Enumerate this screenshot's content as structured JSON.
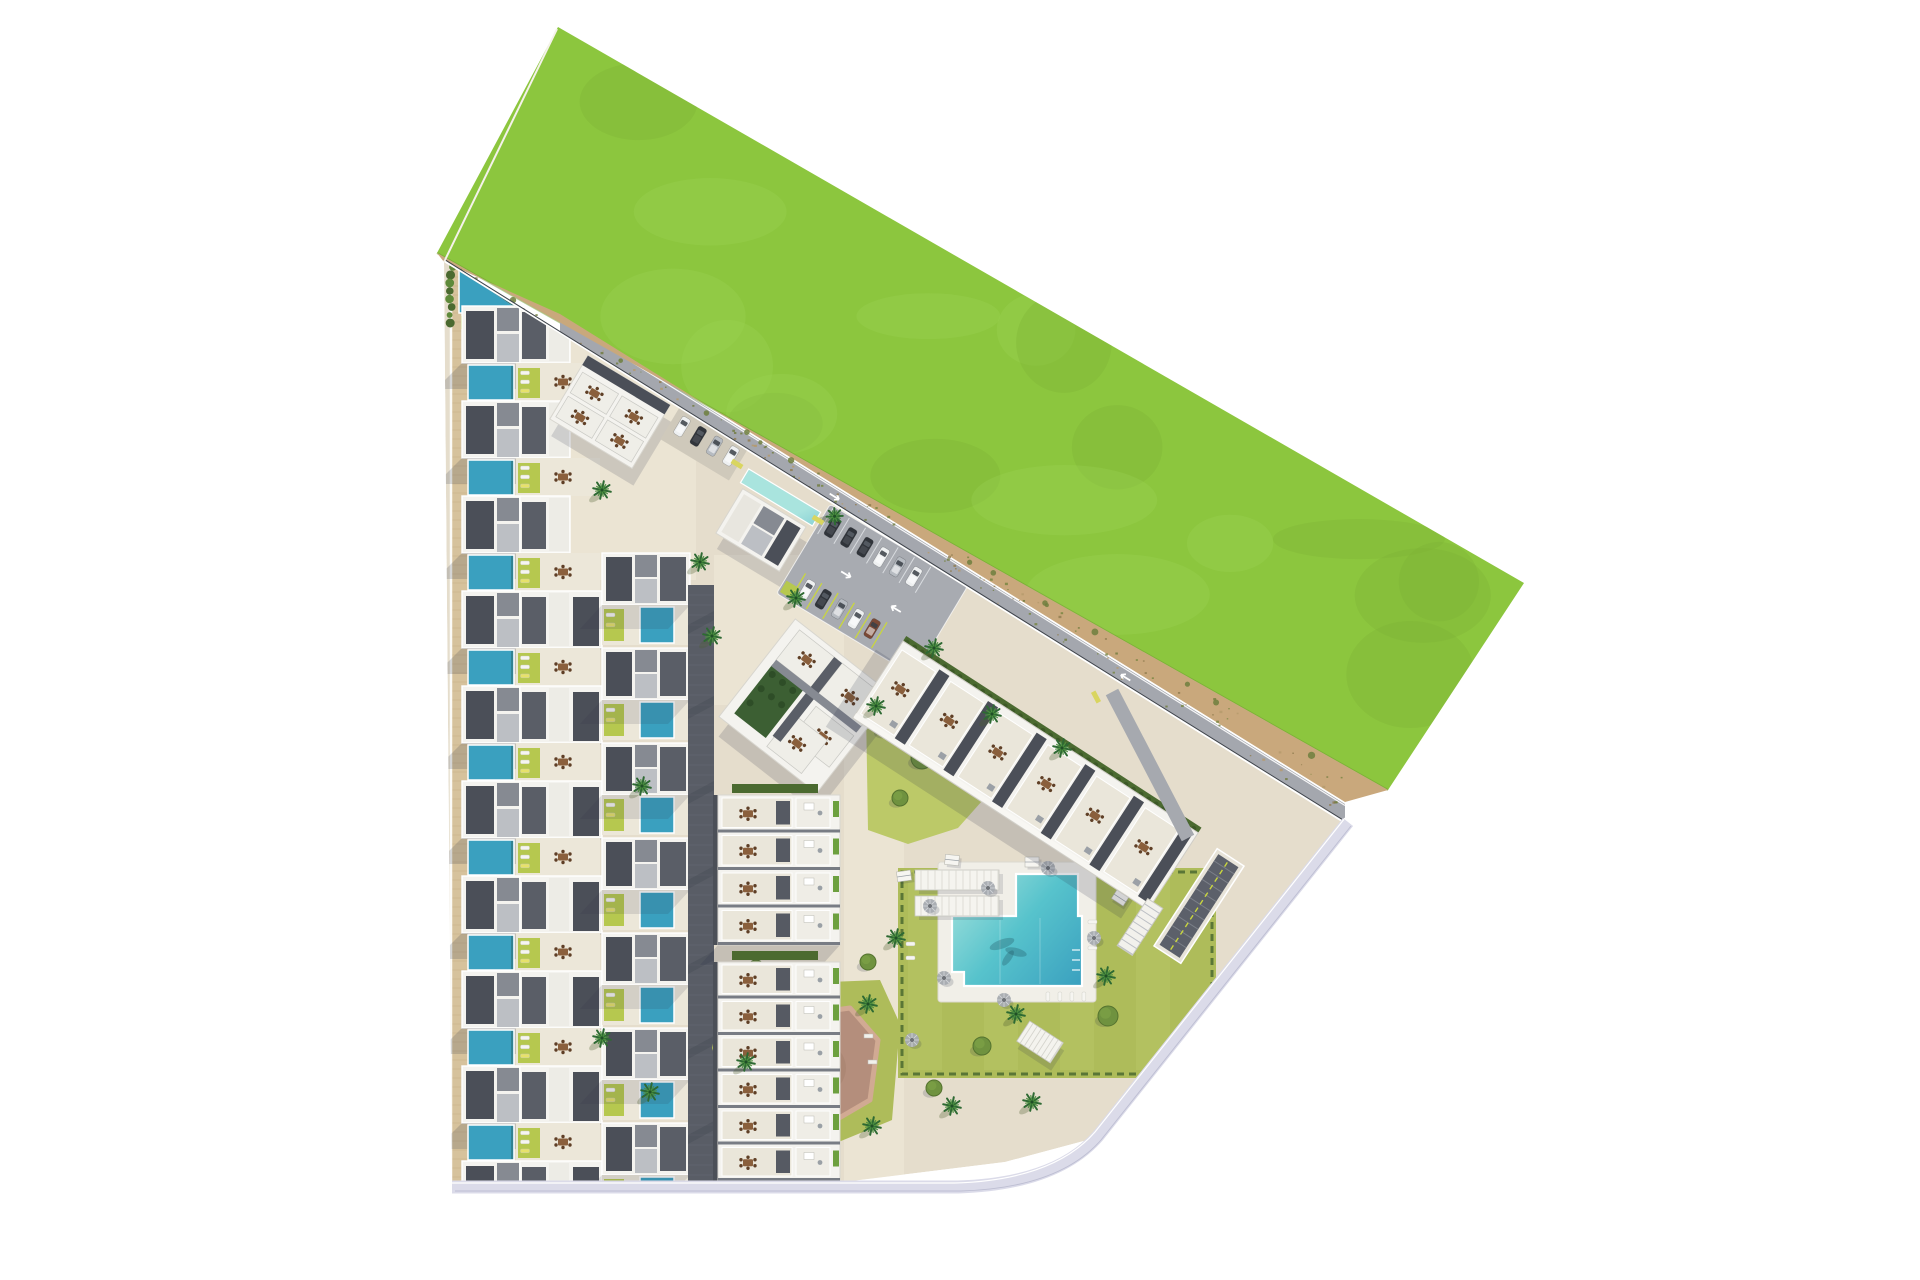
{
  "scene": {
    "type": "residential-masterplan-aerial-rendering",
    "background": "#ffffff",
    "description": "Top-down architectural site plan: rows of townhouses with private pools on the west, apartment blocks and parking in the centre, communal garden with swimming pool and playground on the south-east, large green field across the north-east, sandy track along the diagonal boundary."
  },
  "palette": {
    "bg": "#ffffff",
    "field_green": "#8cc63e",
    "field_green_light": "#9cd355",
    "field_green_dark": "#7cb134",
    "dirt": "#c9a87c",
    "dirt_dark": "#8f7a4e",
    "dirt_olive": "#75853e",
    "dirt_light": "#b59a6b",
    "road": "#a4a7ae",
    "road_edge": "#ffffff",
    "se_road": "#dbdbe9",
    "se_road_edge": "#b9bacf",
    "pavement": "#e5ddcc",
    "pavement_light": "#ece5d5",
    "tan_path": "#d6c29c",
    "tan_tick": "#c4ae84",
    "lane": "#595d66",
    "lane_line": "#6a6e77",
    "building_white": "#f4f3ef",
    "floor_beige": "#eae6da",
    "roof_dark": "#4b4f58",
    "roof_slate": "#5a5e67",
    "roof_mid": "#868a92",
    "roof_light": "#bcbfc4",
    "pool_light": "#a9e4de",
    "pool_mid": "#57c3cc",
    "pool_deep": "#3aa0bf",
    "chartreuse": "#b6c84f",
    "olive_lawn": "#aebc5a",
    "olive_light": "#bcc968",
    "hedge": "#4b6a30",
    "tree_green": "#6f923f",
    "palm_green": "#2e6a33",
    "palm_light": "#4c8f3f",
    "shadow": "#2b3148",
    "wood": "#8a5f3c",
    "wood_dark": "#5f3f26",
    "yellow": "#d9d560",
    "stall_yellow": "#c9d63e",
    "play_pad": "#b48e7c",
    "play_ring": "#d1aa93",
    "play_dark": "#9f7a68",
    "parasol": "#a7abb0",
    "car_dark": "#30343a",
    "car_white": "#eef0f1",
    "car_silver": "#b6bbc1",
    "car_brown": "#7a4936"
  },
  "site": {
    "green_field": {
      "points": "558,27 1524,583 1388,790 437,253",
      "mottle_count": 18
    },
    "dirt_track": {
      "points": "437,253 1388,790 1345,802 560,314 444,262",
      "speckle_count": 130,
      "shrub_count": 14
    },
    "perimeter_road": {
      "x1": 560,
      "y1": 316,
      "x2": 1345,
      "y2": 804,
      "width": 20
    },
    "fence": {
      "x1": 444,
      "y1": 262,
      "x2": 1345,
      "y2": 824
    },
    "apex_edge": {
      "x1": 444,
      "y1": 262,
      "x2": 557,
      "y2": 29
    },
    "pavement": {
      "points": "444,262 560,334 1345,824 1095,1138 1005,1162 835,1183 452,1183"
    },
    "se_road_path": "M1348,822 L1098,1136 Q1056,1184 958,1187 L452,1187",
    "tan_path": {
      "x": 452,
      "y": 262,
      "w": 16,
      "h": 921
    },
    "light_patches": [
      {
        "x": 556,
        "y": 270,
        "w": 140,
        "h": 310
      },
      {
        "x": 714,
        "y": 555,
        "w": 130,
        "h": 150
      },
      {
        "x": 844,
        "y": 695,
        "w": 60,
        "h": 488
      }
    ]
  },
  "townhouses": {
    "row_count": 10,
    "first_garden_y": 268,
    "pitch": 95,
    "x_left": 462,
    "x_right": 690,
    "short_right_rows": 3,
    "apex_garden": {
      "pool_points": "459,268 524,313 459,313",
      "lawn": {
        "x": 461,
        "y": 316,
        "w": 60,
        "h": 13
      },
      "lounger_count": 5,
      "pergola": {
        "x": 462,
        "y": 338,
        "w": 31,
        "h": 24
      },
      "dining": [
        [
          512,
          349
        ],
        [
          552,
          349
        ]
      ],
      "shrub_count": 8
    }
  },
  "access_lane": {
    "x": 688,
    "y": 585,
    "w": 26,
    "h": 598
  },
  "amenities": {
    "north_building": {
      "cx": 610,
      "cy": 412,
      "rot": 31,
      "w": 96,
      "h": 74
    },
    "north_parking": {
      "cx": 706,
      "cy": 441,
      "rot": 31,
      "w": 80,
      "h": 44,
      "cars": [
        "white",
        "dark",
        "silver",
        "white"
      ]
    },
    "clubhouse": {
      "cx": 761,
      "cy": 530,
      "rot": 31,
      "w": 74,
      "h": 52,
      "pool": {
        "x": -42,
        "y": -46,
        "w": 84,
        "h": 16
      }
    },
    "main_parking": {
      "cx": 872,
      "cy": 590,
      "rot": 31,
      "w": 160,
      "h": 104,
      "row_a": [
        "dark",
        "dark",
        "dark",
        "white",
        "silver",
        "white"
      ],
      "row_b": [
        "white",
        "dark",
        "silver",
        "white",
        "brown"
      ]
    },
    "yellow_benches": [
      [
        737,
        464,
        31
      ],
      [
        818,
        520,
        31
      ],
      [
        1096,
        697,
        62
      ]
    ]
  },
  "apartment_blocks": {
    "block_a": {
      "cx": 806,
      "cy": 706,
      "rot": 38,
      "size": 124
    },
    "block_b": {
      "x": 903,
      "y": 641,
      "rot": 33,
      "len": 352,
      "depth": 92,
      "units": 6
    },
    "block_c": {
      "x": 718,
      "y": 795,
      "w": 122,
      "rows": 4,
      "row_h": 37.5
    },
    "block_d": {
      "x": 718,
      "y": 962,
      "w": 122,
      "rows": 6,
      "row_h": 36.5
    }
  },
  "garden": {
    "upper_lawn": "866,708 912,694 958,710 986,742 990,792 958,828 908,844 868,830",
    "main_lawn": {
      "x": 898,
      "y": 868,
      "w": 318,
      "h": 210
    },
    "play_lawn": "726,986 880,980 900,1024 892,1120 824,1148 742,1134 712,1048",
    "deck": {
      "x": 938,
      "y": 862,
      "w": 158,
      "h": 140
    },
    "pool_path": "M952,916 L1016,916 L1016,874 L1078,874 L1078,916 L1082,916 L1082,986 L964,986 L964,972 L952,972 Z",
    "pergolas": [
      [
        915,
        870,
        84,
        20
      ],
      [
        915,
        896,
        84,
        20
      ]
    ],
    "parasols": [
      [
        930,
        906
      ],
      [
        944,
        978
      ],
      [
        988,
        888
      ],
      [
        1004,
        1000
      ],
      [
        1094,
        938
      ],
      [
        1048,
        868
      ],
      [
        912,
        1040
      ]
    ],
    "cabanas": [
      [
        904,
        876,
        -8
      ],
      [
        952,
        860,
        6
      ],
      [
        1120,
        898,
        33
      ],
      [
        1032,
        862,
        0
      ]
    ],
    "trees": [
      [
        886,
        728,
        9
      ],
      [
        922,
        758,
        11
      ],
      [
        900,
        798,
        8
      ],
      [
        1142,
        872,
        10
      ],
      [
        1184,
        924,
        12
      ],
      [
        1108,
        1016,
        10
      ],
      [
        982,
        1046,
        9
      ],
      [
        934,
        1088,
        8
      ],
      [
        1064,
        800,
        8
      ],
      [
        1010,
        764,
        7
      ],
      [
        868,
        962,
        8
      ],
      [
        846,
        1060,
        9
      ],
      [
        756,
        968,
        8
      ]
    ],
    "palms": [
      [
        876,
        706
      ],
      [
        992,
        714
      ],
      [
        1062,
        748
      ],
      [
        896,
        938
      ],
      [
        1016,
        1014
      ],
      [
        1106,
        976
      ],
      [
        952,
        1106
      ],
      [
        1032,
        1102
      ],
      [
        868,
        1004
      ],
      [
        746,
        1062
      ],
      [
        872,
        1126
      ],
      [
        700,
        562
      ],
      [
        642,
        786
      ],
      [
        650,
        1092
      ],
      [
        602,
        1038
      ],
      [
        712,
        636
      ],
      [
        796,
        598
      ],
      [
        934,
        648
      ],
      [
        602,
        490
      ],
      [
        660,
        350
      ]
    ],
    "deck_loungers_row": {
      "x": 1046,
      "y": 992,
      "count": 4,
      "step": 12
    },
    "deck_loungers_col": {
      "x": 1088,
      "y": 920,
      "count": 3,
      "step": 13
    },
    "lawn_lounger_pairs": [
      [
        906,
        942
      ],
      [
        906,
        956
      ]
    ]
  },
  "playground": {
    "pad_points": "748,1022 850,1008 878,1040 870,1100 822,1128 756,1118 728,1062",
    "benches": [
      [
        864,
        1034
      ],
      [
        868,
        1060
      ]
    ]
  },
  "structures": {
    "pavilion": {
      "cx": 1140,
      "cy": 927,
      "rot": 33,
      "w": 18,
      "h": 56
    },
    "pergola_south": {
      "cx": 1040,
      "cy": 1042,
      "rot": 33,
      "w": 40,
      "h": 24
    },
    "garage_ramp": {
      "cx": 1199,
      "cy": 906,
      "rot": 33,
      "w": 32,
      "h": 116
    },
    "branch_road": {
      "x1": 1112,
      "y1": 692,
      "x2": 1188,
      "y2": 838,
      "width": 14
    }
  }
}
